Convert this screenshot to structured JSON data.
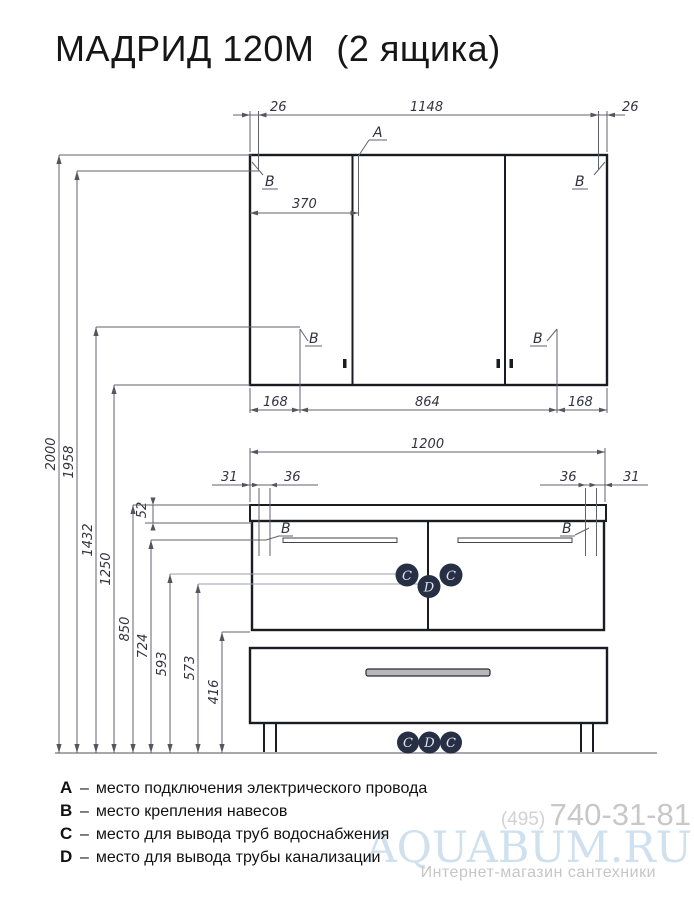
{
  "title": {
    "main": "МАДРИД 120М",
    "suffix": "(2 ящика)"
  },
  "markers": {
    "a": "A",
    "b": "B",
    "c": "C",
    "d": "D"
  },
  "dims": {
    "top": {
      "left": "26",
      "span": "1148",
      "right": "26"
    },
    "mirror_inner": "370",
    "mirror_bottom": {
      "left": "168",
      "center": "864",
      "right": "168"
    },
    "vanity_width": "1200",
    "vanity_left": {
      "edge": "31",
      "inset": "36"
    },
    "vanity_right": {
      "inset": "36",
      "edge": "31"
    },
    "countertop": "52",
    "heights": [
      "2000",
      "1958",
      "1432",
      "1250",
      "850",
      "724",
      "593",
      "573",
      "416"
    ]
  },
  "legend_sep": "–",
  "legend": [
    {
      "key": "A",
      "desc": "место подключения электрического провода"
    },
    {
      "key": "B",
      "desc": "место крепления навесов"
    },
    {
      "key": "C",
      "desc": "место для вывода труб водоснабжения"
    },
    {
      "key": "D",
      "desc": "место для вывода трубы канализации"
    }
  ],
  "watermark": {
    "phone_prefix": "(495)",
    "phone": "740-31-81",
    "brand": "AQUABUM.RU",
    "tagline": "Интернет-магазин сантехники"
  },
  "colors": {
    "marker_circle": "#272f45",
    "line": "#1b1b22",
    "dim_line": "#62626e",
    "brand": "#cfe0ee"
  }
}
